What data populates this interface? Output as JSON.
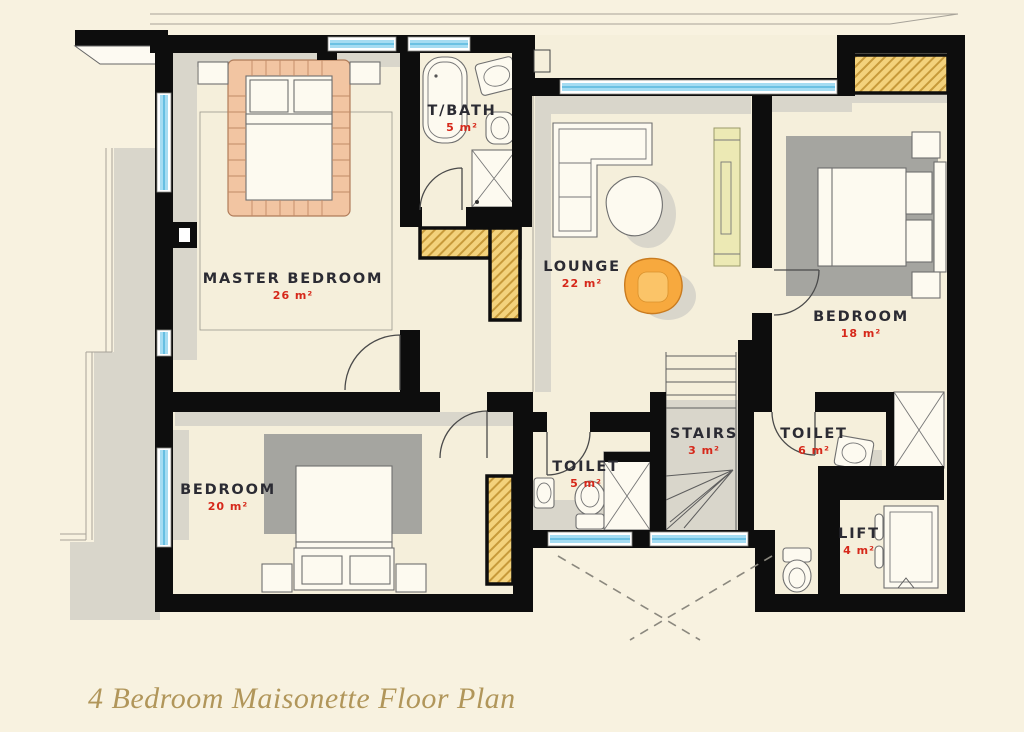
{
  "page": {
    "background": "#f8f2e0",
    "title": "4 Bedroom Maisonette Floor Plan"
  },
  "colors": {
    "title": "#b1965a",
    "wall": "#0d0d0d",
    "floor": "#f5efdb",
    "shadow": "#d9d6cb",
    "rug": "#a5a5a0",
    "window_glass": "#a5dcf2",
    "window_line": "#58b8de",
    "wardrobe_fill": "#f3d27c",
    "wardrobe_line": "#c79a3a",
    "bed_frame": "#f2c5a2",
    "tv_console": "#ece9b4",
    "armchair": "#f7a93e",
    "furniture_fill": "#fdfaf0",
    "furniture_line": "#6f6f6f",
    "label": "#2b2b33",
    "area": "#d6281a"
  },
  "rooms": [
    {
      "name": "MASTER BEDROOM",
      "area": "26 m²"
    },
    {
      "name": "T/BATH",
      "area": "5 m²"
    },
    {
      "name": "LOUNGE",
      "area": "22 m²"
    },
    {
      "name": "BEDROOM",
      "area": "18 m²"
    },
    {
      "name": "BEDROOM",
      "area": "20 m²"
    },
    {
      "name": "TOILET",
      "area": "5 m²"
    },
    {
      "name": "STAIRS",
      "area": "3 m²"
    },
    {
      "name": "TOILET",
      "area": "6 m²"
    },
    {
      "name": "LIFT",
      "area": "4 m²"
    }
  ]
}
